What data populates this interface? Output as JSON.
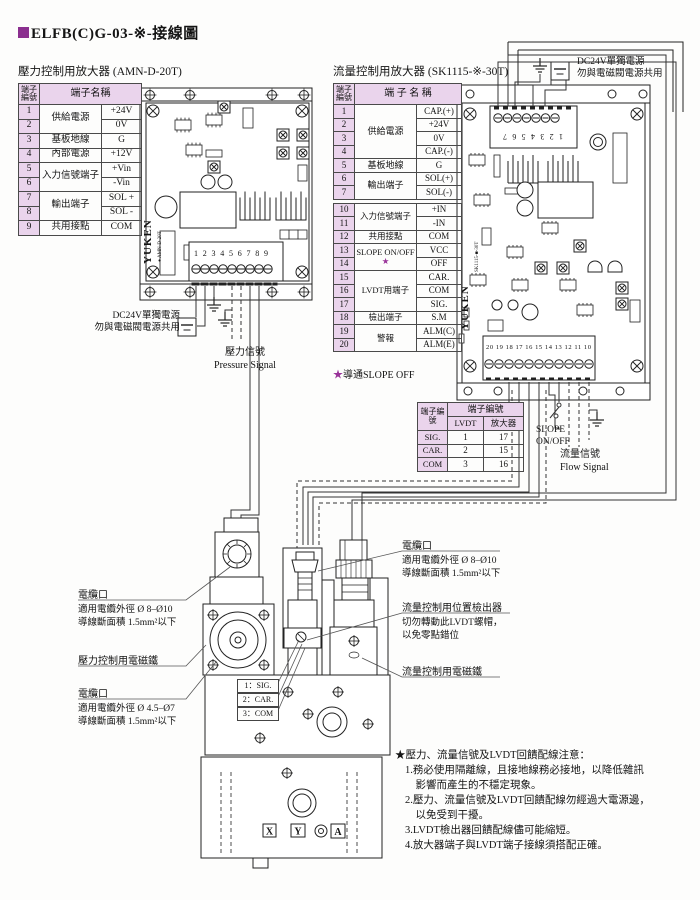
{
  "title": {
    "text": "ELFB(C)G-03-※-接線圖"
  },
  "colors": {
    "accent_purple": "#8b2f8f",
    "table_fill": "#ead4ec",
    "star": "#993399"
  },
  "pressure_amp": {
    "heading": "壓力控制用放大器 (AMN-D-20T)",
    "table": {
      "col_no": "端子編號",
      "col_name": "端子名稱",
      "rows": [
        {
          "no": "1",
          "name": "供給電源",
          "span": 2,
          "val": "+24V"
        },
        {
          "no": "2",
          "val": "0V"
        },
        {
          "no": "3",
          "name": "基板地線",
          "span": 1,
          "val": "G"
        },
        {
          "no": "4",
          "name": "內部電源",
          "span": 1,
          "val": "+12V"
        },
        {
          "no": "5",
          "name": "入力信號端子",
          "span": 2,
          "val": "+Vin"
        },
        {
          "no": "6",
          "val": "-Vin"
        },
        {
          "no": "7",
          "name": "輸出端子",
          "span": 2,
          "val": "SOL +"
        },
        {
          "no": "8",
          "val": "SOL -"
        },
        {
          "no": "9",
          "name": "共用接點",
          "span": 1,
          "val": "COM"
        }
      ]
    },
    "board": {
      "brand": "YUKEN",
      "model": "AMN-D-20T",
      "terminals": "1 2 3 4 5 6 7 8 9"
    },
    "power_note": [
      "DC24V單獨電源",
      "勿與電磁閥電源共用"
    ],
    "signal_zh": "壓力信號",
    "signal_en": "Pressure Signal"
  },
  "flow_amp": {
    "heading": "流量控制用放大器 (SK1115-※-30T)",
    "table": {
      "col_no": "端子編號",
      "col_name": "端 子 名 稱",
      "rows_top": [
        {
          "no": "1",
          "name": "供給電源",
          "span": 4,
          "val": "CAP.(+)"
        },
        {
          "no": "2",
          "val": "+24V"
        },
        {
          "no": "3",
          "val": "0V"
        },
        {
          "no": "4",
          "val": "CAP.(-)"
        },
        {
          "no": "5",
          "name": "基板地線",
          "span": 1,
          "val": "G"
        },
        {
          "no": "6",
          "name": "輸出端子",
          "span": 2,
          "val": "SOL(+)"
        },
        {
          "no": "7",
          "val": "SOL(-)"
        }
      ],
      "rows_bottom": [
        {
          "no": "10",
          "name": "入力信號端子",
          "span": 2,
          "val": "+IN"
        },
        {
          "no": "11",
          "val": "-IN"
        },
        {
          "no": "12",
          "name": "共用接點",
          "span": 1,
          "val": "COM"
        },
        {
          "no": "13",
          "name": "SLOPE ON/OFF",
          "star": true,
          "span": 2,
          "val": "VCC"
        },
        {
          "no": "14",
          "val": "OFF"
        },
        {
          "no": "15",
          "name": "LVDT用端子",
          "span": 3,
          "val": "CAR."
        },
        {
          "no": "16",
          "val": "COM"
        },
        {
          "no": "17",
          "val": "SIG."
        },
        {
          "no": "18",
          "name": "檢出端子",
          "span": 1,
          "val": "S.M"
        },
        {
          "no": "19",
          "name": "警報",
          "span": 2,
          "val": "ALM(C)"
        },
        {
          "no": "20",
          "val": "ALM(E)"
        }
      ]
    },
    "footnote_star": "★",
    "footnote": "導通SLOPE OFF",
    "board": {
      "brand": "YUKEN",
      "model": "SK1115-■-30T",
      "top_terminals": "1 2 3 4 5 6 7",
      "bottom_terminals": "20 19 18 17 16 15 14 13 12 11 10"
    },
    "power_note": [
      "DC24V單獨電源",
      "勿與電磁閥電源共用"
    ],
    "slope_label": [
      "SLOPE",
      "ON/OFF"
    ],
    "signal_zh": "流量信號",
    "signal_en": "Flow Signal"
  },
  "lvdt_table": {
    "col_no": "端子編號",
    "col_group": "端子編號",
    "col_lvdt": "LVDT",
    "col_amp": "放大器",
    "rows": [
      {
        "pin": "SIG.",
        "lvdt": "1",
        "amp": "17"
      },
      {
        "pin": "CAR.",
        "lvdt": "2",
        "amp": "15"
      },
      {
        "pin": "COM",
        "lvdt": "3",
        "amp": "16"
      }
    ]
  },
  "valve": {
    "lvdt_pins": [
      "1：SIG.",
      "2：CAR.",
      "3：COM"
    ],
    "ports": [
      "X",
      "Y",
      "A"
    ],
    "callouts_left": [
      {
        "title": "電纜口",
        "lines": [
          "適用電纜外徑 Ø 8–Ø10",
          "導線斷面積 1.5mm²以下"
        ]
      },
      {
        "title": "壓力控制用電磁鐵",
        "lines": []
      },
      {
        "title": "電纜口",
        "lines": [
          "適用電纜外徑 Ø 4.5–Ø7",
          "導線斷面積 1.5mm²以下"
        ]
      }
    ],
    "callouts_right": [
      {
        "title": "電纜口",
        "lines": [
          "適用電纜外徑 Ø 8–Ø10",
          "導線斷面積 1.5mm²以下"
        ]
      },
      {
        "title": "流量控制用位置檢出器",
        "lines": [
          "切勿轉動此LVDT螺帽，",
          "以免零點錯位"
        ]
      },
      {
        "title": "流量控制用電磁鐵",
        "lines": []
      }
    ]
  },
  "notes": {
    "title": "★壓力、流量信號及LVDT回饋配線注意：",
    "items": [
      "1.務必使用隔離線，且接地線務必接地，以降低雜訊",
      "　影響而產生的不穩定現象。",
      "2.壓力、流量信號及LVDT回饋配線勿經過大電源邊，",
      "　以免受到干擾。",
      "3.LVDT檢出器回饋配線儘可能縮短。",
      "4.放大器端子與LVDT端子接線須搭配正確。"
    ]
  }
}
